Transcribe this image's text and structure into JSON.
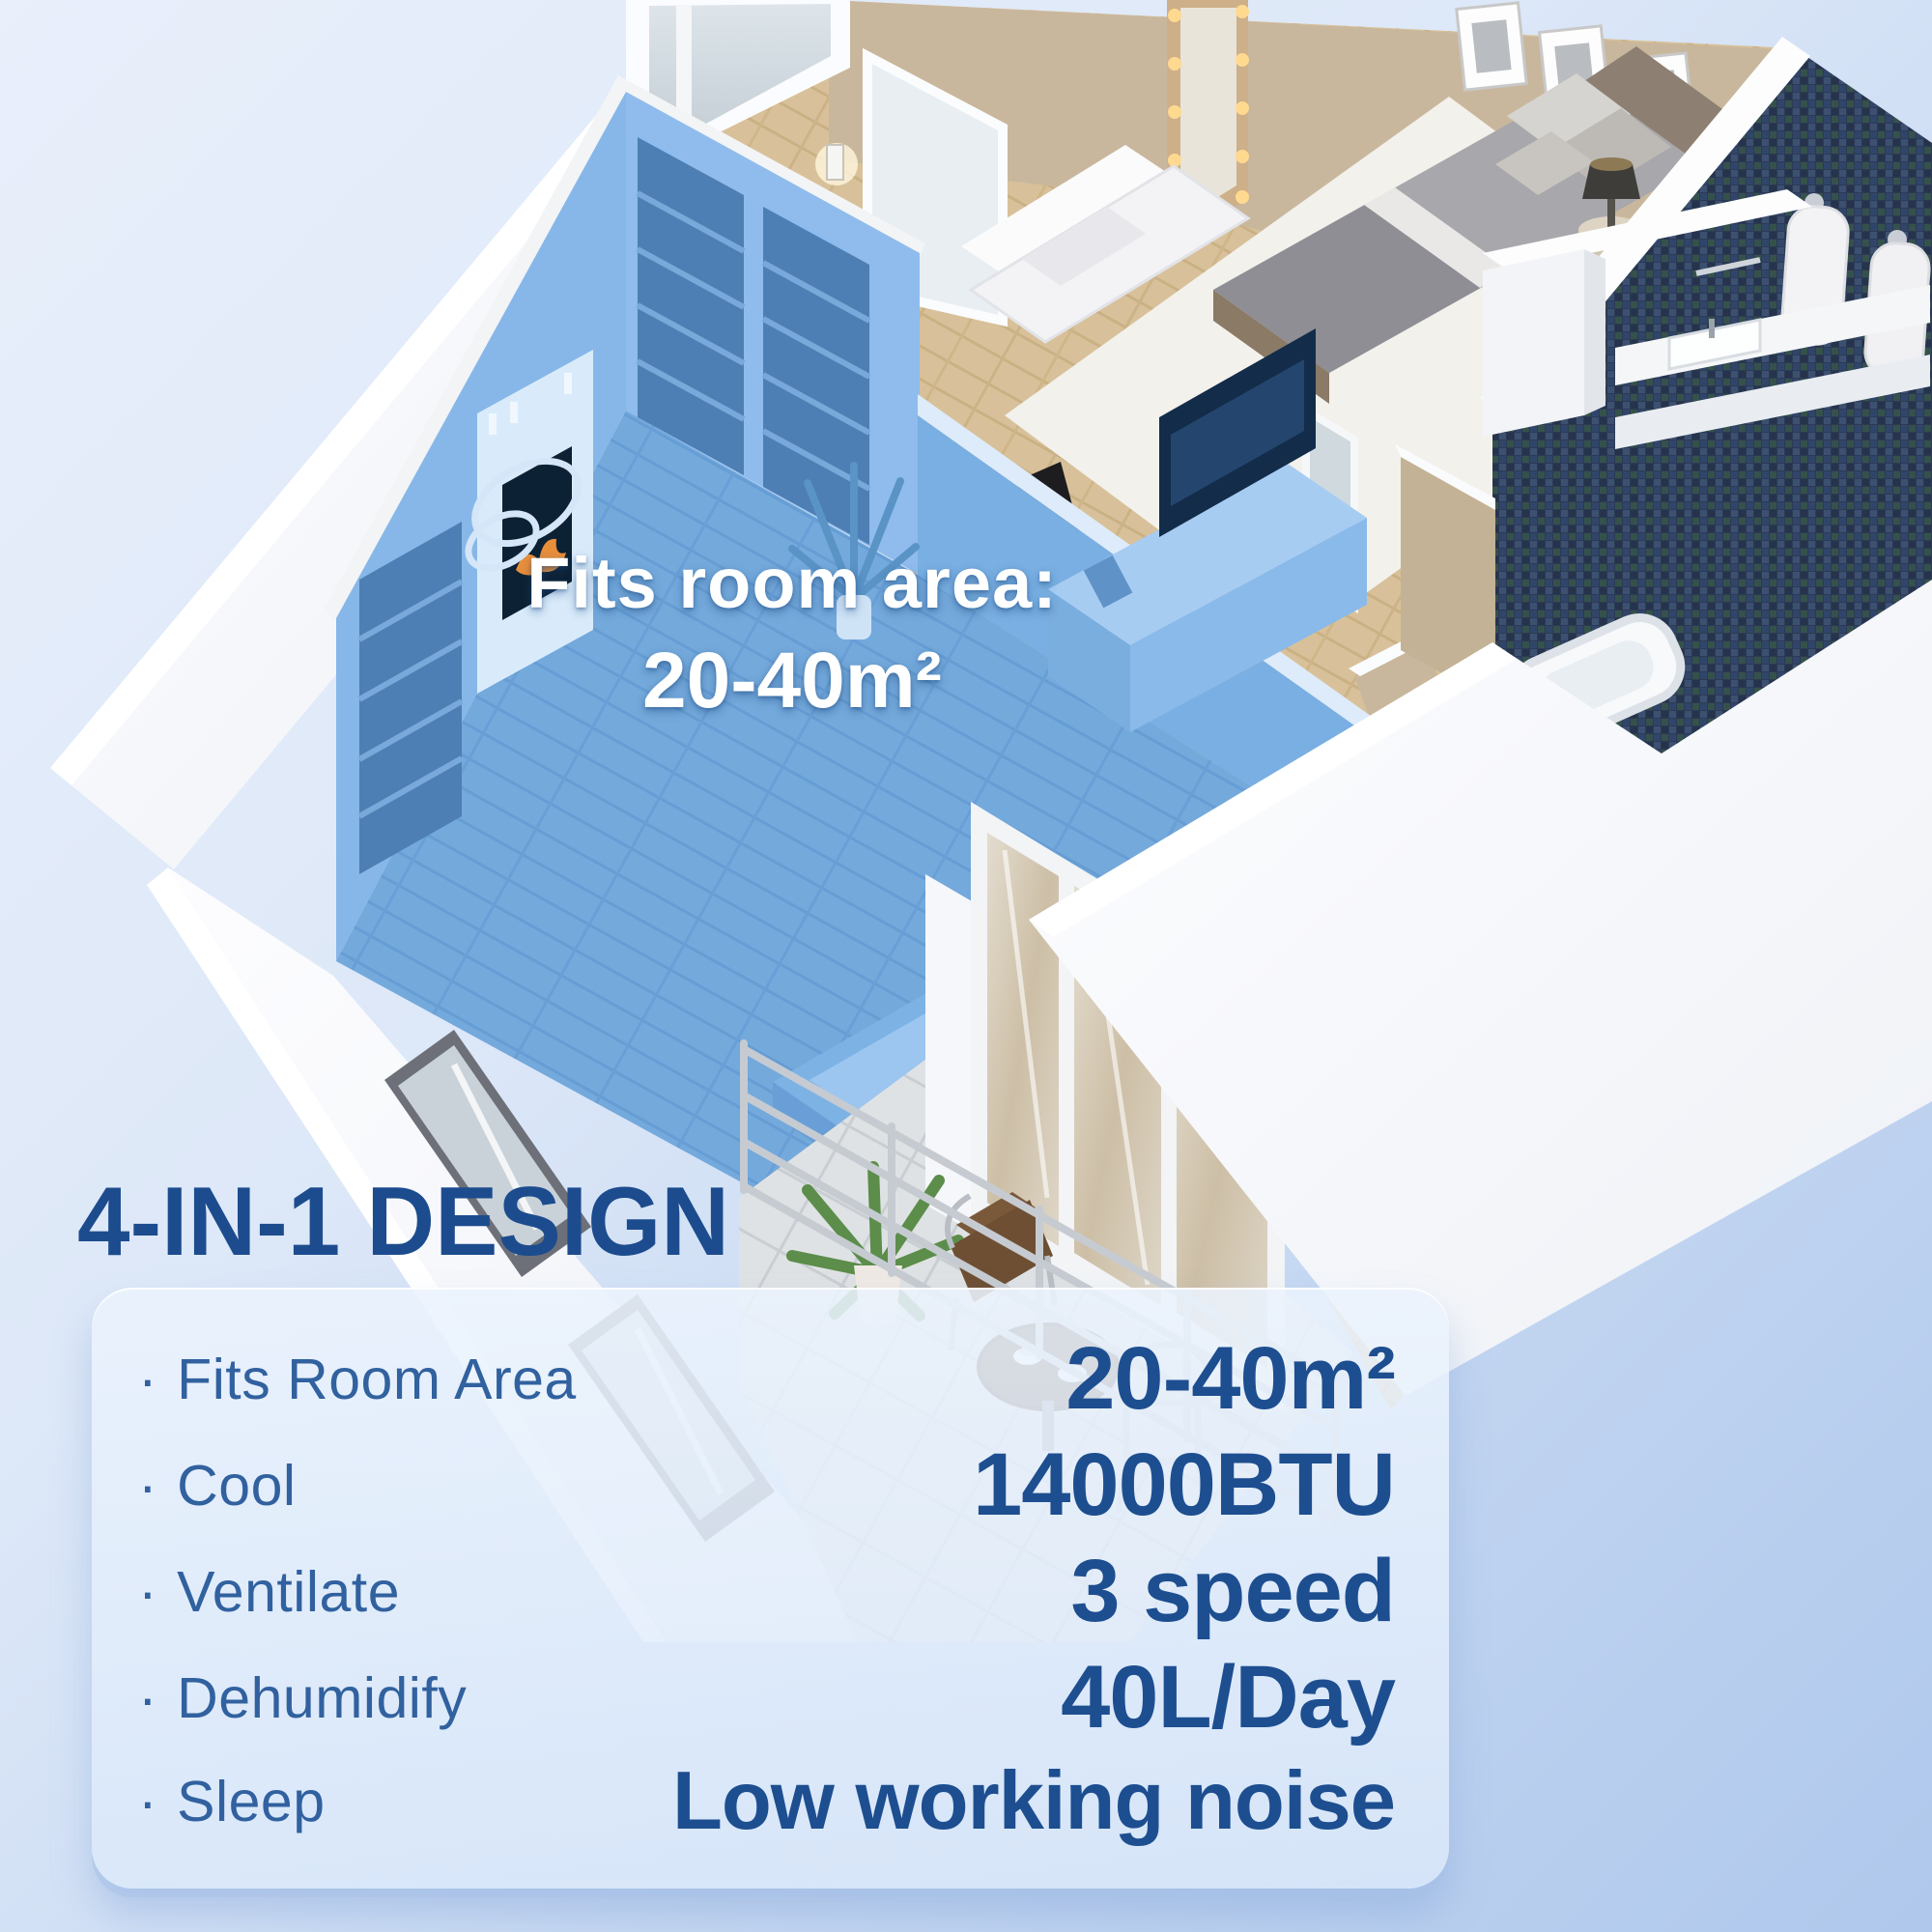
{
  "scene": {
    "overlay": {
      "title": "Fits room area:",
      "value": "20-40m²"
    }
  },
  "heading": "4-IN-1 DESIGN",
  "panel": {
    "bullet": "·",
    "features": [
      {
        "label": "Fits Room Area",
        "value": "20-40m²"
      },
      {
        "label": "Cool",
        "value": "14000BTU"
      },
      {
        "label": "Ventilate",
        "value": "3 speed"
      },
      {
        "label": "Dehumidify",
        "value": "40L/Day"
      },
      {
        "label": "Sleep",
        "value": "Low working noise"
      }
    ]
  },
  "colors": {
    "heading_blue": "#1c4c8e",
    "label_blue": "#31619f",
    "value_blue": "#1d4e90",
    "highlight_blue": "#6ba6de",
    "overlay_text": "#ffffff",
    "panel_bg": "#e3eefc",
    "mosaic_navy": "#2c3a55",
    "wood": "#d7c099",
    "wall_beige": "#c9b79d"
  }
}
